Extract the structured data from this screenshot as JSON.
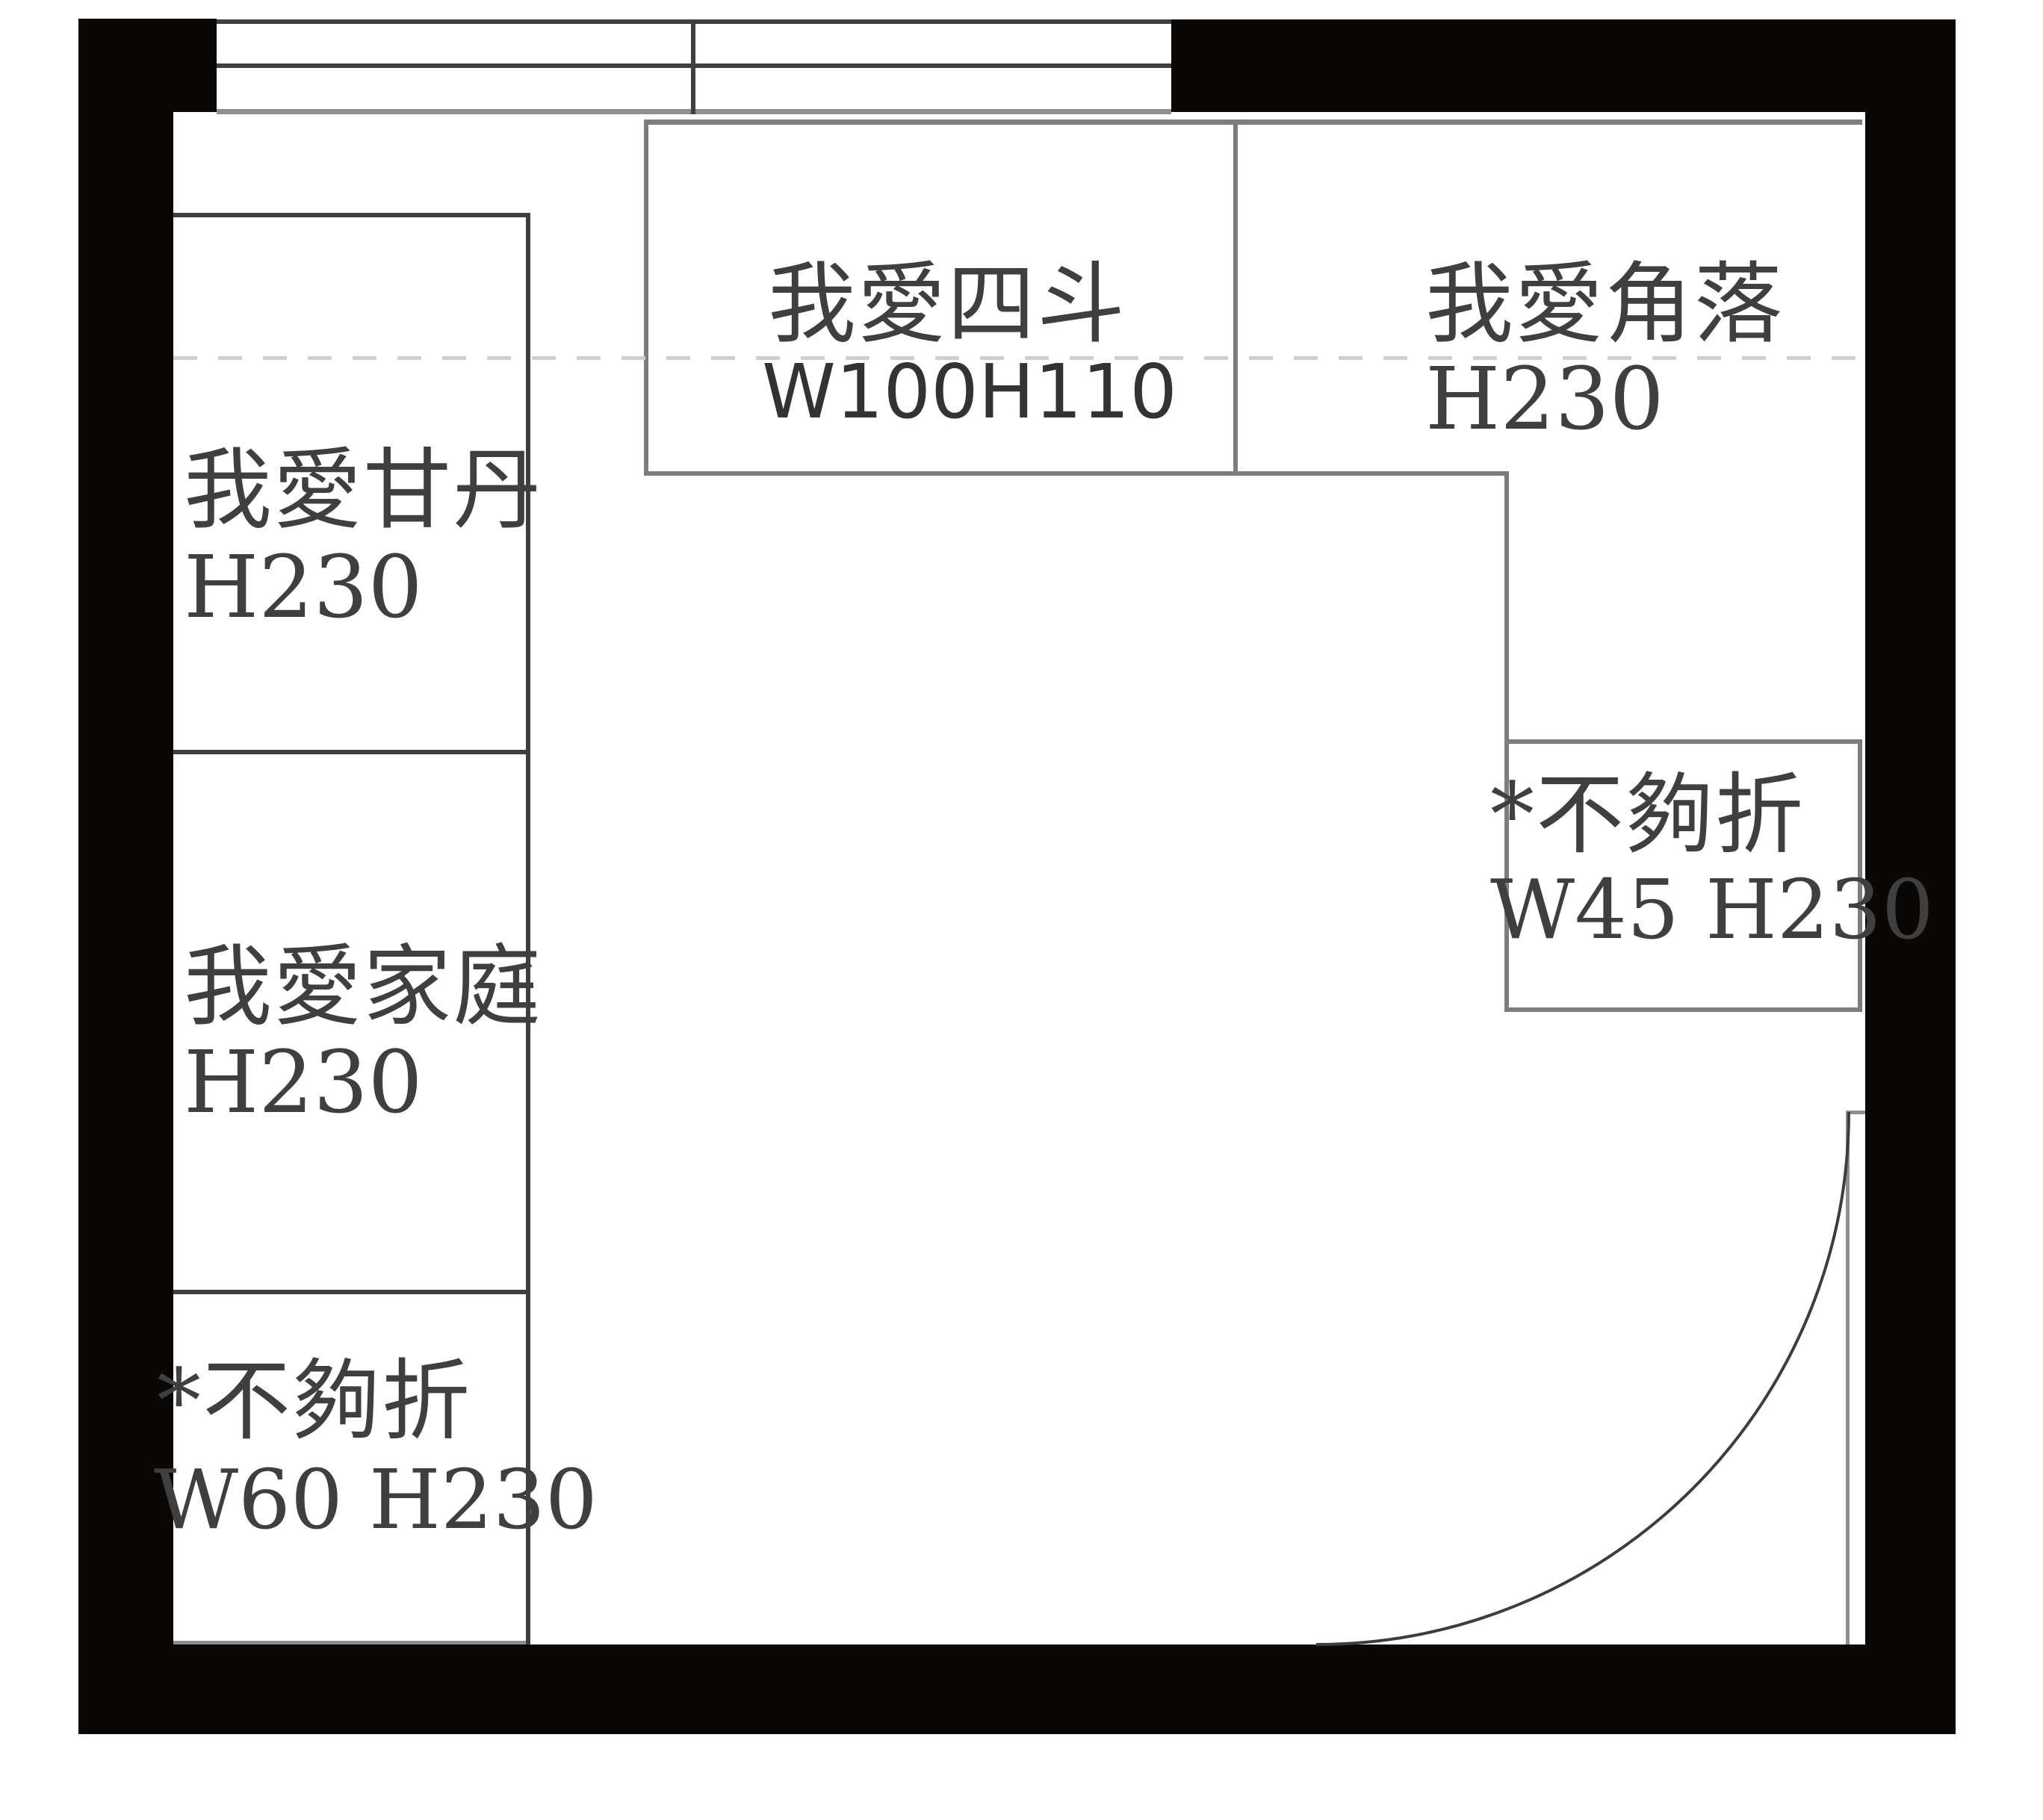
{
  "plan": {
    "kind": "cabinet floor plan",
    "wall_color": "#0a0705",
    "line_color": "#3f3f3f",
    "box_line_color": "#7d7d7d",
    "dashed_line_color": "#cfcfcf",
    "text_color": "#3f3f3f",
    "background": "#ffffff"
  },
  "cabinets": [
    {
      "id": "left-top",
      "label": "我愛甘丹",
      "dims": "H230"
    },
    {
      "id": "left-middle",
      "label": "我愛家庭",
      "dims": "H230"
    },
    {
      "id": "left-bottom",
      "label": "*不夠折",
      "dims": "W60 H230"
    },
    {
      "id": "top-center",
      "label": "我愛四斗",
      "dims": "W100H110"
    },
    {
      "id": "top-right",
      "label": "我愛角落",
      "dims": "H230"
    },
    {
      "id": "right",
      "label": "*不夠折",
      "dims": "W45 H230"
    }
  ]
}
